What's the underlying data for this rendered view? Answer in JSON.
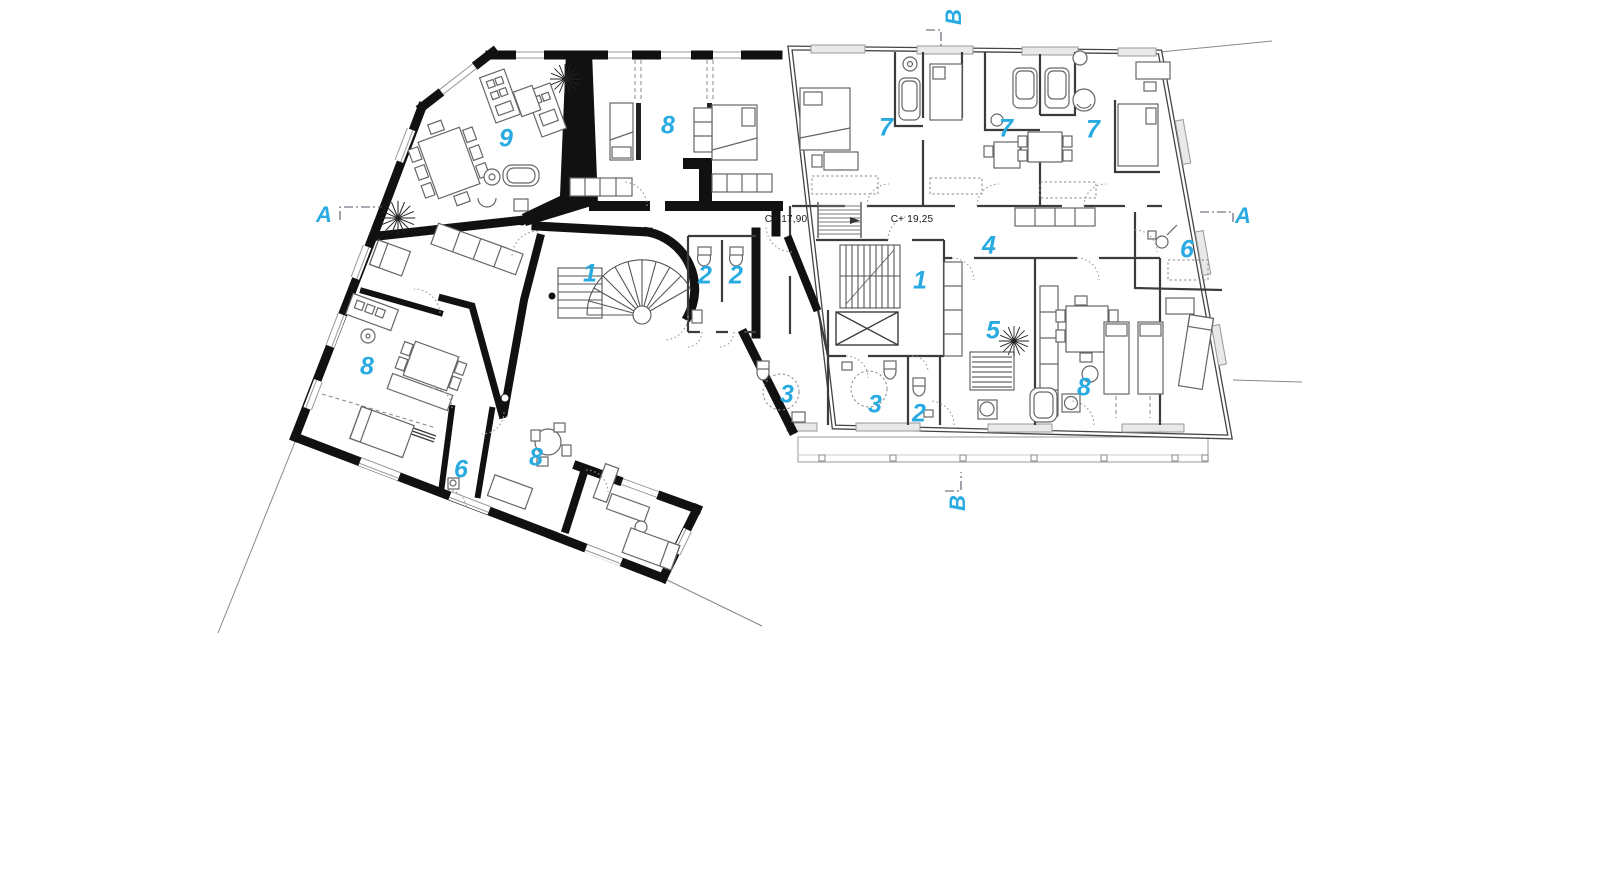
{
  "palette": {
    "accent": "#29ABE2",
    "wall": "#111111",
    "partition": "#3C3C3C",
    "furniture_line": "#666666",
    "light_line": "#999999"
  },
  "room_labels": [
    {
      "text": "9",
      "x": 506,
      "y": 139
    },
    {
      "text": "8",
      "x": 668,
      "y": 126
    },
    {
      "text": "7",
      "x": 886,
      "y": 128
    },
    {
      "text": "7",
      "x": 1006,
      "y": 129
    },
    {
      "text": "7",
      "x": 1093,
      "y": 130
    },
    {
      "text": "6",
      "x": 1187,
      "y": 250
    },
    {
      "text": "4",
      "x": 989,
      "y": 246
    },
    {
      "text": "1",
      "x": 920,
      "y": 281
    },
    {
      "text": "2",
      "x": 705,
      "y": 276
    },
    {
      "text": "2",
      "x": 736,
      "y": 276
    },
    {
      "text": "1",
      "x": 590,
      "y": 274
    },
    {
      "text": "5",
      "x": 993,
      "y": 331
    },
    {
      "text": "8",
      "x": 1084,
      "y": 388
    },
    {
      "text": "3",
      "x": 787,
      "y": 395
    },
    {
      "text": "3",
      "x": 875,
      "y": 405
    },
    {
      "text": "2",
      "x": 919,
      "y": 414
    },
    {
      "text": "8",
      "x": 367,
      "y": 367
    },
    {
      "text": "6",
      "x": 461,
      "y": 470
    },
    {
      "text": "8",
      "x": 536,
      "y": 458
    }
  ],
  "section_markers": [
    {
      "text": "A",
      "x": 324,
      "y": 215,
      "rotate": 0
    },
    {
      "text": "A",
      "x": 1243,
      "y": 216,
      "rotate": 0
    },
    {
      "text": "B",
      "x": 954,
      "y": 17,
      "rotate": -90
    },
    {
      "text": "B",
      "x": 958,
      "y": 503,
      "rotate": -90
    }
  ],
  "level_annotations": [
    {
      "text": "C+ 17,90",
      "x": 786,
      "y": 220
    },
    {
      "text": "C+ 19,25",
      "x": 912,
      "y": 220
    }
  ]
}
